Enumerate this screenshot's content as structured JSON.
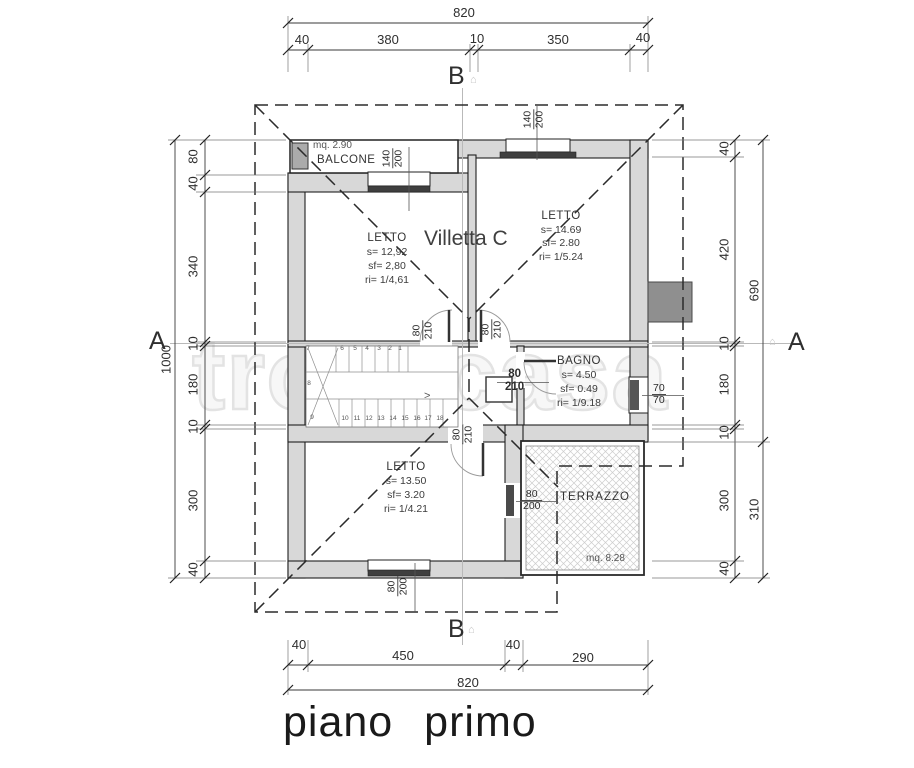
{
  "watermark": "trovacasa",
  "plan": {
    "title": "Villetta C",
    "floor_label": "piano primo"
  },
  "section_markers": {
    "a_left": "A",
    "a_right": "A",
    "b_top": "B",
    "b_bottom": "B",
    "house_icon": "⌂"
  },
  "rooms": {
    "balcone": {
      "name": "BALCONE",
      "area": "mq. 2.90"
    },
    "letto_nw": {
      "name": "LETTO",
      "s": "s= 12,92",
      "sf": "sf= 2,80",
      "ri": "ri= 1/4,61"
    },
    "letto_ne": {
      "name": "LETTO",
      "s": "s= 14.69",
      "sf": "sf= 2.80",
      "ri": "ri= 1/5.24"
    },
    "bagno": {
      "name": "BAGNO",
      "s": "s= 4.50",
      "sf": "sf= 0.49",
      "ri": "ri= 1/9.18"
    },
    "letto_s": {
      "name": "LETTO",
      "s": "s= 13.50",
      "sf": "sf= 3.20",
      "ri": "ri= 1/4.21"
    },
    "terrazzo": {
      "name": "TERRAZZO",
      "area": "mq. 8.28"
    }
  },
  "openings": {
    "balcone_window": {
      "w": "140",
      "h": "200"
    },
    "ne_window": {
      "w": "140",
      "h": "200"
    },
    "door_nw": {
      "w": "80",
      "h": "210"
    },
    "door_ne": {
      "w": "80",
      "h": "210"
    },
    "door_bagno": {
      "w": "80",
      "h": "210"
    },
    "door_s": {
      "w": "80",
      "h": "210"
    },
    "door_terrazzo": {
      "w": "80",
      "h": "200"
    },
    "s_window": {
      "w": "80",
      "h": "200"
    },
    "bagno_window": {
      "w": "70",
      "h": "70"
    }
  },
  "dimensions": {
    "top": {
      "total": "820",
      "segments": [
        "40",
        "380",
        "10",
        "350",
        "40"
      ]
    },
    "bottom": {
      "total": "820",
      "segments": [
        "40",
        "450",
        "40",
        "290"
      ]
    },
    "left": {
      "total": "1000",
      "segments": [
        "80",
        "40",
        "340",
        "10",
        "180",
        "10",
        "300",
        "40"
      ]
    },
    "right": {
      "segments": [
        "40",
        "420",
        "10",
        "180",
        "10",
        "300",
        "40"
      ],
      "outer": [
        "690",
        "310"
      ]
    }
  },
  "stairs": {
    "top_steps": [
      "7",
      "6",
      "5",
      "4",
      "3",
      "2",
      "1"
    ],
    "mid_step": "8",
    "bottom_steps": [
      "9",
      "10",
      "11",
      "12",
      "13",
      "14",
      "15",
      "16",
      "17",
      "18"
    ],
    "arrow": ">"
  }
}
